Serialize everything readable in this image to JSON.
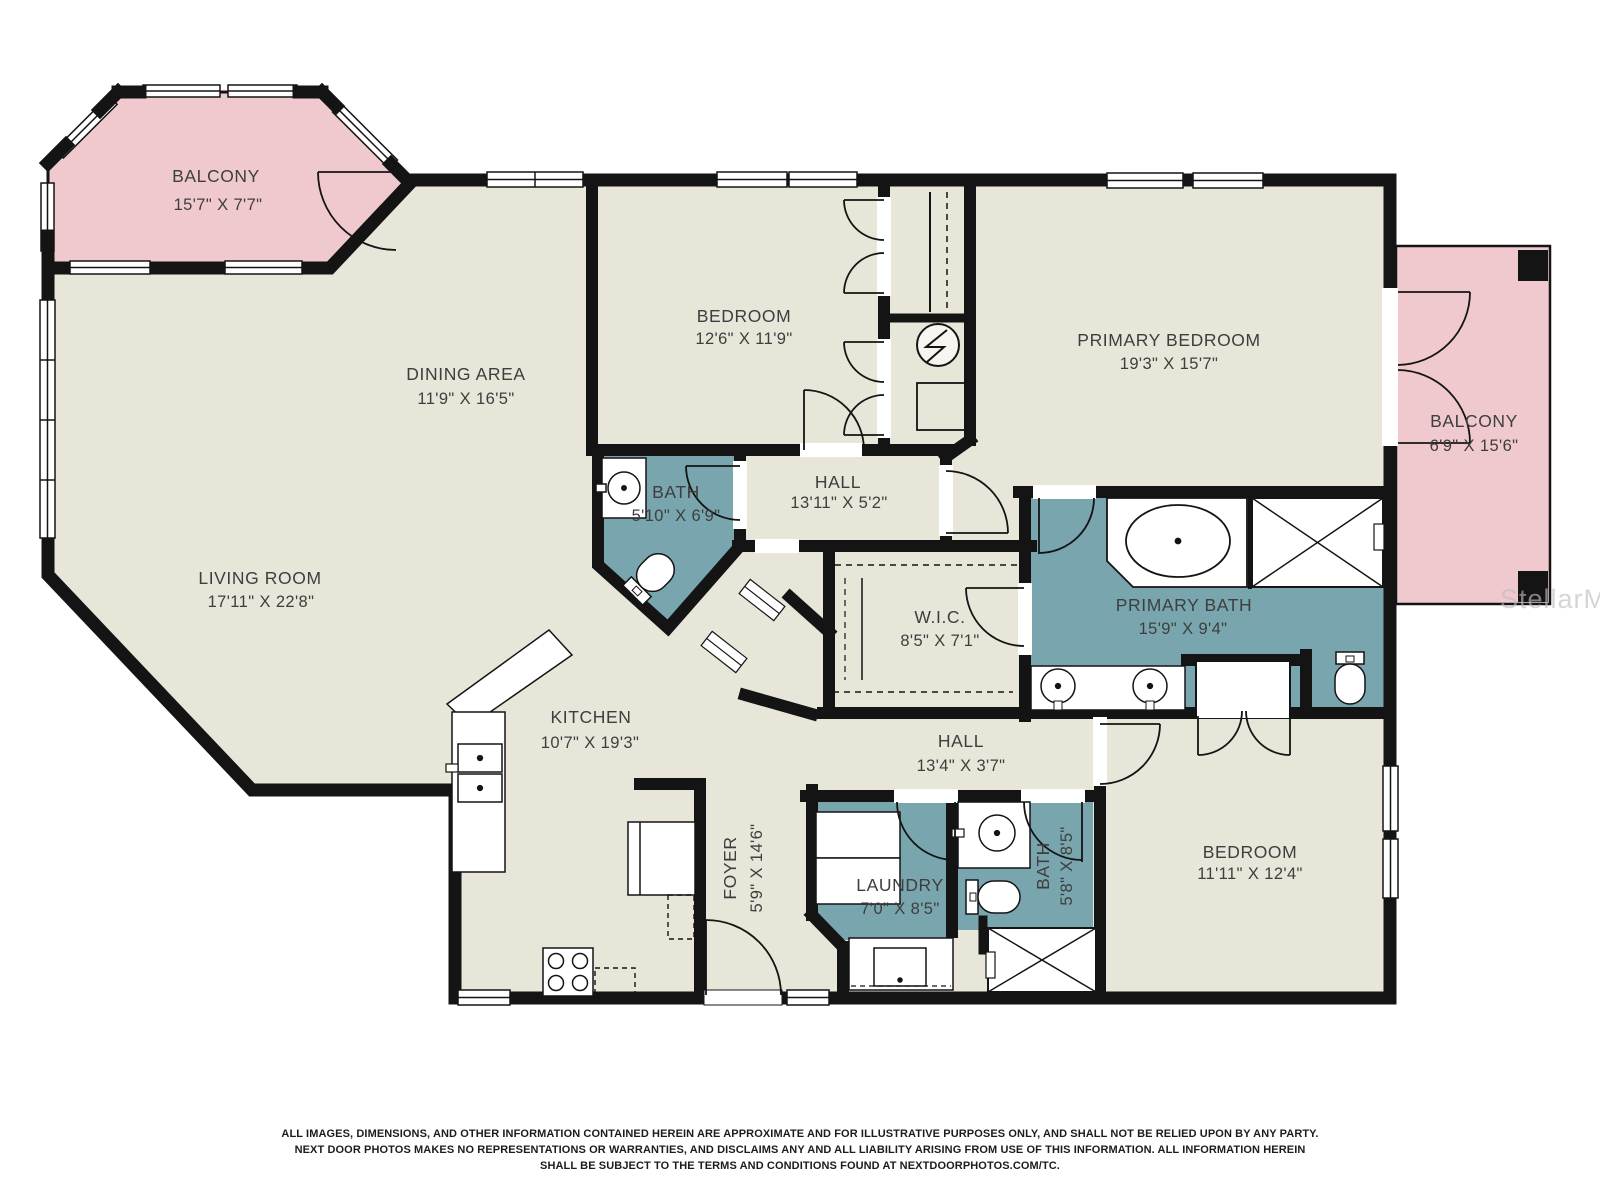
{
  "plan": {
    "rooms": {
      "balcony_top_left": {
        "name": "BALCONY",
        "dims": "15'7\" X 7'7\""
      },
      "dining": {
        "name": "DINING AREA",
        "dims": "11'9\" X 16'5\""
      },
      "bedroom_top": {
        "name": "BEDROOM",
        "dims": "12'6\" X 11'9\""
      },
      "primary_bedroom": {
        "name": "PRIMARY BEDROOM",
        "dims": "19'3\" X 15'7\""
      },
      "balcony_right": {
        "name": "BALCONY",
        "dims": "6'9\" X 15'6\""
      },
      "bath_top": {
        "name": "BATH",
        "dims": "5'10\" X 6'9\""
      },
      "hall_top": {
        "name": "HALL",
        "dims": "13'11\" X 5'2\""
      },
      "living": {
        "name": "LIVING ROOM",
        "dims": "17'11\" X 22'8\""
      },
      "wic": {
        "name": "W.I.C.",
        "dims": "8'5\" X 7'1\""
      },
      "primary_bath": {
        "name": "PRIMARY BATH",
        "dims": "15'9\" X 9'4\""
      },
      "kitchen": {
        "name": "KITCHEN",
        "dims": "10'7\" X 19'3\""
      },
      "hall_bottom": {
        "name": "HALL",
        "dims": "13'4\" X 3'7\""
      },
      "foyer": {
        "name": "FOYER",
        "dims": "5'9\" X 14'6\""
      },
      "laundry": {
        "name": "LAUNDRY",
        "dims": "7'0\" X 8'5\""
      },
      "bath_bottom": {
        "name": "BATH",
        "dims": "5'8\" X 8'5\""
      },
      "bedroom_bottom": {
        "name": "BEDROOM",
        "dims": "11'11\" X 12'4\""
      }
    },
    "watermark": "StellarMLS",
    "disclaimer": {
      "line1": "ALL IMAGES, DIMENSIONS, AND OTHER INFORMATION CONTAINED HEREIN ARE APPROXIMATE AND FOR ILLUSTRATIVE PURPOSES ONLY, AND SHALL NOT BE RELIED UPON BY ANY PARTY.",
      "line2": "NEXT DOOR PHOTOS MAKES NO REPRESENTATIONS OR WARRANTIES, AND DISCLAIMS ANY AND ALL LIABILITY ARISING FROM USE OF THIS INFORMATION. ALL INFORMATION HEREIN",
      "line3": "SHALL BE SUBJECT TO THE TERMS AND CONDITIONS FOUND AT NEXTDOORPHOTOS.COM/TC."
    },
    "colors": {
      "floor": "#e8e5d9",
      "wet_room": "#78a5ae",
      "balcony": "#f0c9ce",
      "wall": "#141414",
      "label_text": "#3e3e3e"
    }
  }
}
